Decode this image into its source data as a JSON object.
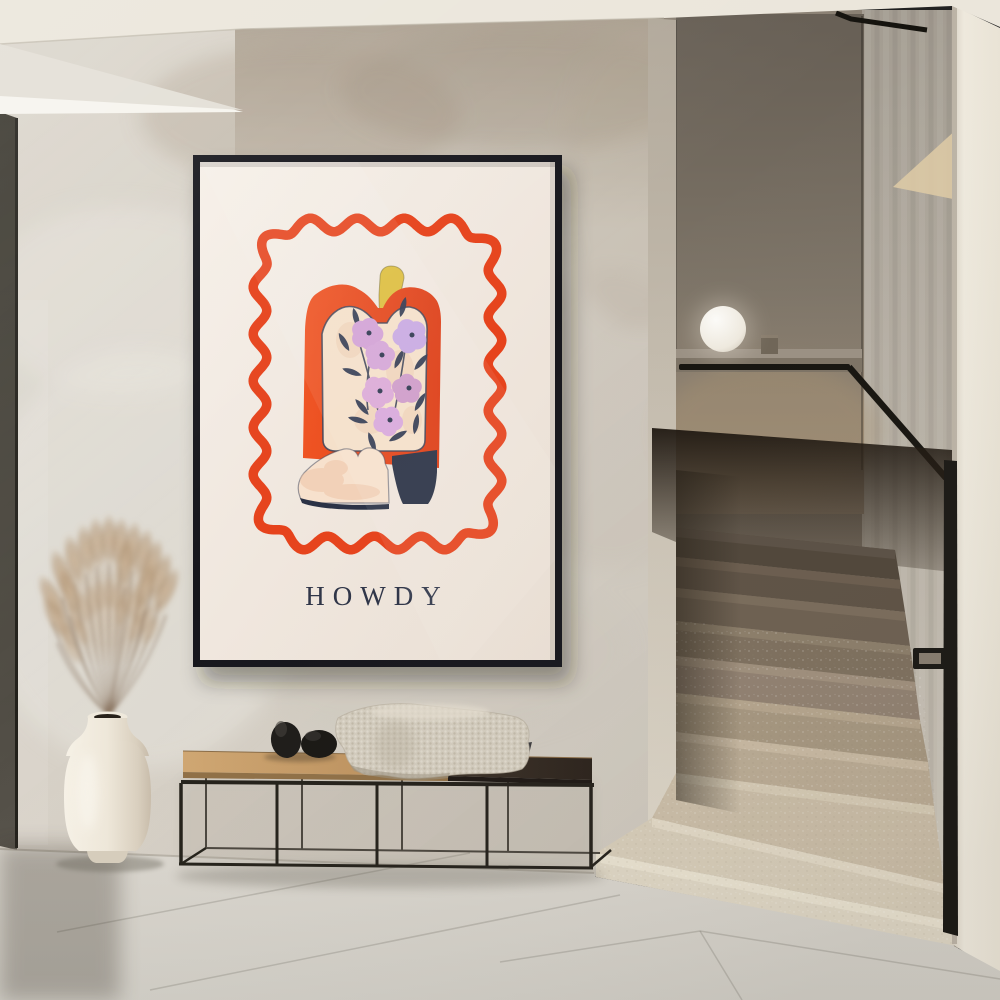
{
  "scene": {
    "setting": "minimalist hallway with staircase",
    "poster": {
      "title": "HOWDY",
      "frame_color": "#17171a",
      "paper_color": "#f3ebe2",
      "border_color": "#e6431c",
      "text_color": "#2e3447",
      "boot": {
        "shaft_color": "#e84b1e",
        "panel_color": "#f5e0ca",
        "flower_colors": [
          "#d2a2d6",
          "#c9a9e2",
          "#d6a6d8",
          "#dcaad8",
          "#cf9cca",
          "#d9a9dc"
        ],
        "stem_color": "#2f3850",
        "strap_color": "#ddbe3e",
        "foot_color": "#f7e1cd",
        "heel_color": "#2b3245"
      }
    },
    "objects": {
      "bench": "black metal bench with oak and dark wood seat",
      "blanket": "chunky knit cream throw",
      "stones": "two black pebble sculptures",
      "vase": "cream ceramic floor vase with dried pampas grass",
      "lamp": "white sphere lamp on stair ledge",
      "stairs": "terrazzo staircase with black handrail"
    },
    "palette": {
      "wall": "#d6d0c6",
      "ceiling": "#ebe6db",
      "floor": "#d7d3cc",
      "handrail": "#15130e",
      "stair_light": "#e0d8c6",
      "stair_dark": "#4f4539"
    }
  }
}
